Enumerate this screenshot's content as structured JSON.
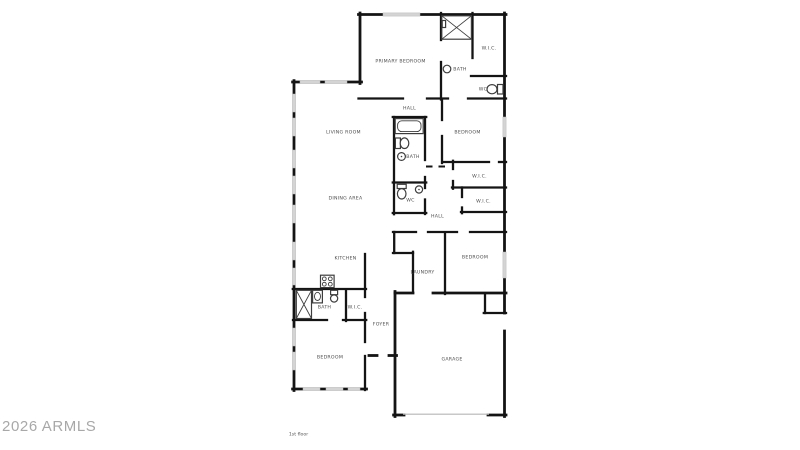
{
  "watermark": "2026 ARMLS",
  "floor_label": "1st floor",
  "floorplan": {
    "rooms": {
      "primary_bedroom": "PRIMARY BEDROOM",
      "wic_primary": "W.I.C.",
      "bath_primary": "BATH",
      "wc_primary": "WC",
      "hall_upper": "HALL",
      "living_room": "LIVING ROOM",
      "bedroom_2": "BEDROOM",
      "bath_2": "BATH",
      "wic_2": "W.I.C.",
      "dining_area": "DINING AREA",
      "wc_2": "WC",
      "wic_3": "W.I.C.",
      "hall_lower": "HALL",
      "kitchen": "KITCHEN",
      "bedroom_3": "BEDROOM",
      "laundry": "LAUNDRY",
      "bath_3": "BATH",
      "wic_4": "W.I.C.",
      "foyer": "FOYER",
      "bedroom_4": "BEDROOM",
      "garage": "GARAGE"
    },
    "fixtures": [
      "shower-icon",
      "bathtub-icon",
      "toilet-icon",
      "sink-icon",
      "stove-icon"
    ],
    "colors": {
      "wall": "#141414",
      "window": "#d4d4d4",
      "fixture_outline": "#3d3d3d",
      "room_label": "#4d4d4d",
      "watermark": "#a8a8a8",
      "background": "#ffffff"
    }
  }
}
